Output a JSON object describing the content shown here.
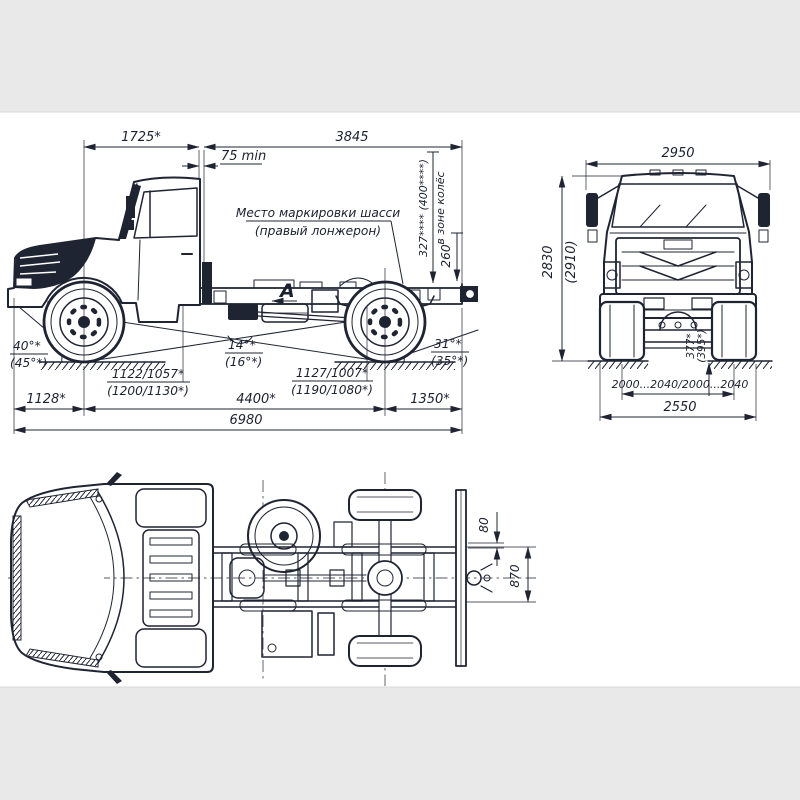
{
  "colors": {
    "ink": "#1f2433",
    "paper": "#ffffff",
    "band": "#e9e9e9"
  },
  "side_view": {
    "dim_1725": "1725*",
    "dim_75min": "75 min",
    "dim_3845": "3845",
    "note_line1": "Место маркировки шасси",
    "note_line2": "(правый лонжерон)",
    "dim_327": "327**** (400****)",
    "dim_327_zone": "в зоне колёс",
    "dim_260": "260",
    "view_label": "А",
    "angle_approach": "40°*",
    "angle_approach_alt": "(45°*)",
    "angle_ramp": "14°*",
    "angle_ramp_alt": "(16°*)",
    "angle_departure": "31°*",
    "angle_departure_alt": "(35°*)",
    "height_front": "1122/1057*",
    "height_front_alt": "(1200/1130*)",
    "height_rear": "1127/1007*",
    "height_rear_alt": "(1190/1080*)",
    "dim_1128": "1128*",
    "dim_4400": "4400*",
    "dim_1350": "1350*",
    "dim_6980": "6980"
  },
  "front_view": {
    "dim_2950": "2950",
    "dim_2830": "2830",
    "dim_2830_alt": "(2910)",
    "dim_clearance": "377*",
    "dim_clearance_alt": "(395*)",
    "dim_track": "2000...2040/2000...2040",
    "dim_2550": "2550"
  },
  "top_view": {
    "dim_80": "80",
    "dim_870": "870"
  }
}
